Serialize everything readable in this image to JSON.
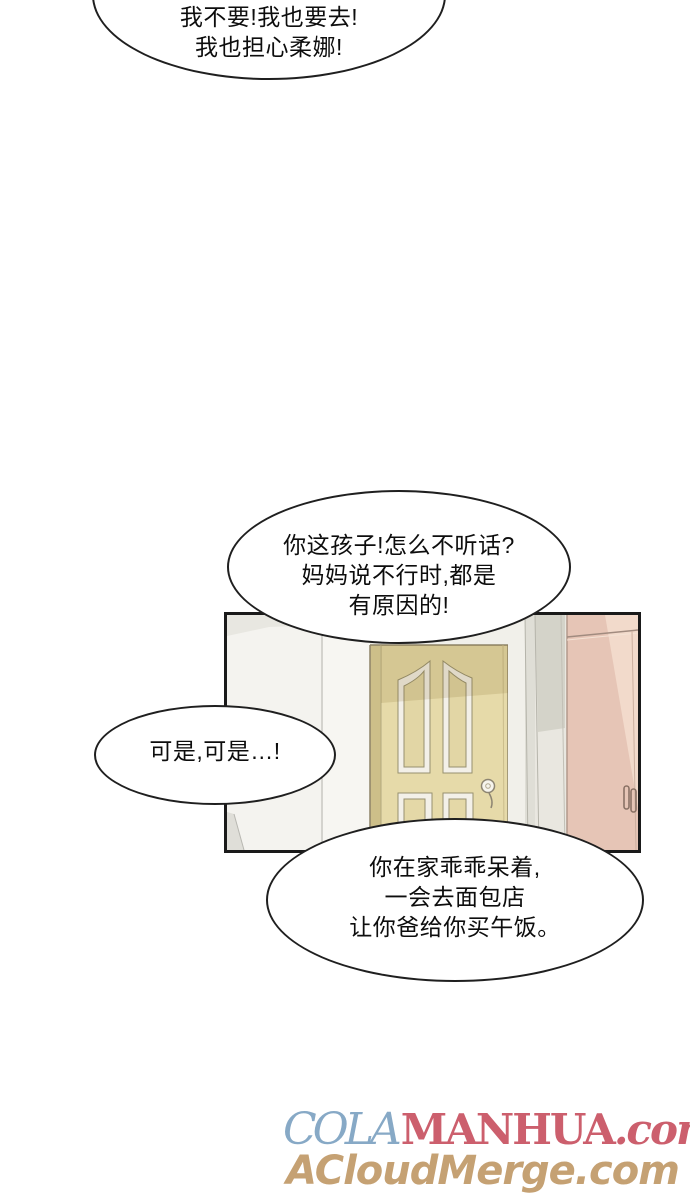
{
  "page": {
    "width": 690,
    "height": 1200,
    "background": "#ffffff",
    "kind": "manhua-comic-page"
  },
  "bubbles": {
    "top": {
      "lines": [
        "我不要!我也要去!",
        "我也担心柔娜!"
      ]
    },
    "middle": {
      "lines": [
        "你这孩子!怎么不听话?",
        "妈妈说不行时,都是",
        "有原因的!"
      ]
    },
    "left": {
      "lines": [
        "可是,可是…!"
      ]
    },
    "bottom": {
      "lines": [
        "你在家乖乖呆着,",
        "一会去面包店",
        "让你爸给你买午饭。"
      ]
    }
  },
  "panel": {
    "scene": "hallway with tan paneled door, gray wall corner and pink wardrobe",
    "colors": {
      "outline": "#1a1a1a",
      "wall_left": "#f4f3ef",
      "wall_band": "#e8e7e1",
      "door_face": "#e6daa9",
      "door_shadow": "#d5c78f",
      "door_edge": "#cdbf89",
      "molding": "#f3f0e8",
      "frame_strip": "#f1f0ea",
      "gray_wall_dark": "#d4d3c9",
      "gray_wall_light": "#e9e7e0",
      "wardrobe_pink": "#e6c5b6",
      "wardrobe_highlight": "#f2dacb",
      "handle": "#8a7265"
    }
  },
  "watermarks": {
    "line1": {
      "cola": "COLA",
      "manhua": "MANHUA",
      "com": ".com",
      "cola_color": "#87a9c6",
      "manhua_color": "#cc5f6d"
    },
    "line2": {
      "text": "ACloudMerge.com",
      "color": "#c5a173"
    }
  }
}
